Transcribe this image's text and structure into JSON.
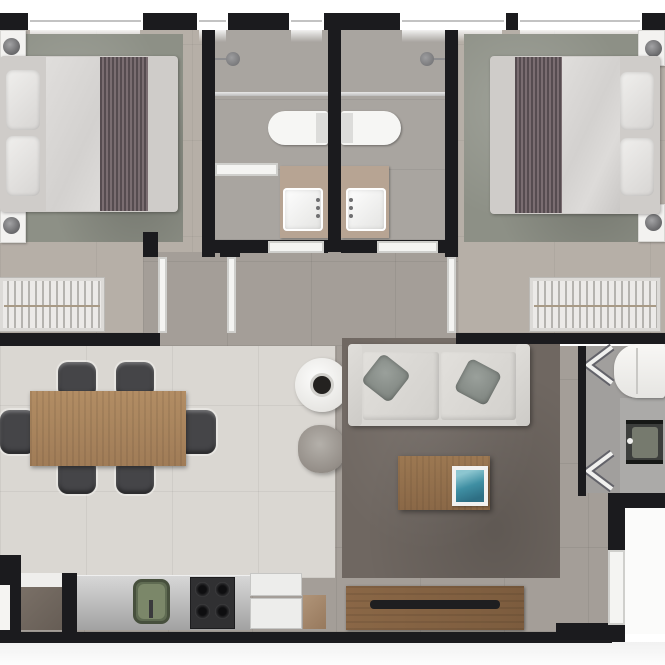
{
  "plan": {
    "kind": "apartment-floor-plan",
    "render_style": "top-down 3D rendered plan, no text labels",
    "rooms": [
      {
        "id": "bedroom-1",
        "label": "Bedroom 1",
        "furniture": [
          "double bed",
          "striped throw",
          "two nightstands with lamps",
          "area rug",
          "wardrobe with hangers"
        ]
      },
      {
        "id": "bathroom-1",
        "label": "Bathroom 1",
        "furniture": [
          "shower head",
          "glass partition",
          "toilet",
          "vanity with sink"
        ]
      },
      {
        "id": "bathroom-2",
        "label": "Bathroom 2",
        "furniture": [
          "shower head",
          "glass partition",
          "toilet",
          "vanity with sink"
        ]
      },
      {
        "id": "bedroom-2",
        "label": "Bedroom 2",
        "furniture": [
          "double bed",
          "striped throw",
          "two nightstands with lamps",
          "area rug",
          "wardrobe with hangers"
        ]
      },
      {
        "id": "hallway",
        "label": "Hallway"
      },
      {
        "id": "dining-area",
        "label": "Dining Area",
        "furniture": [
          "wood dining table",
          "six chairs",
          "round side table with cup",
          "round pouf"
        ]
      },
      {
        "id": "living-room",
        "label": "Living Room",
        "furniture": [
          "two-seat sofa with cushions",
          "coffee table with teal book",
          "area rug",
          "TV rack with TV"
        ]
      },
      {
        "id": "kitchen",
        "label": "Kitchen",
        "furniture": [
          "counter",
          "green sink",
          "four-burner cooktop",
          "refrigerator",
          "cabinet"
        ]
      },
      {
        "id": "laundry",
        "label": "Laundry",
        "furniture": [
          "washing machine",
          "laundry tub",
          "folding-door symbols"
        ]
      },
      {
        "id": "entry",
        "label": "Entry Door"
      }
    ]
  },
  "colors": {
    "wall": "#1b1b1e",
    "floorBedroom": "#b6afa7",
    "floorBath": "#a9a5a0",
    "floorHall": "#a49e98",
    "floorDining": "#dad7d2",
    "floorLaundry": "#a19f9d",
    "rugBedroom": "#8d9086",
    "rugLiving": "#6f6761",
    "bedding": "#cfccc9",
    "throwA": "#564c50",
    "throwB": "#7a6d71",
    "rail": "#a89a86",
    "tan": "#b7a493",
    "wood": "#b28d64",
    "woodRack": "#8a6746",
    "woodCoffee": "#9c7852",
    "sofa": "#d8d6d2",
    "bookTeal": "#3f8fa3",
    "sinkGreen": "#5f6b52",
    "sinkGreenIn": "#7b8769",
    "stove": "#303032",
    "tanque": "#3c3e3c",
    "tanqueBasin": "#767a6e",
    "exteriorBottom": "#f1f1f1"
  }
}
